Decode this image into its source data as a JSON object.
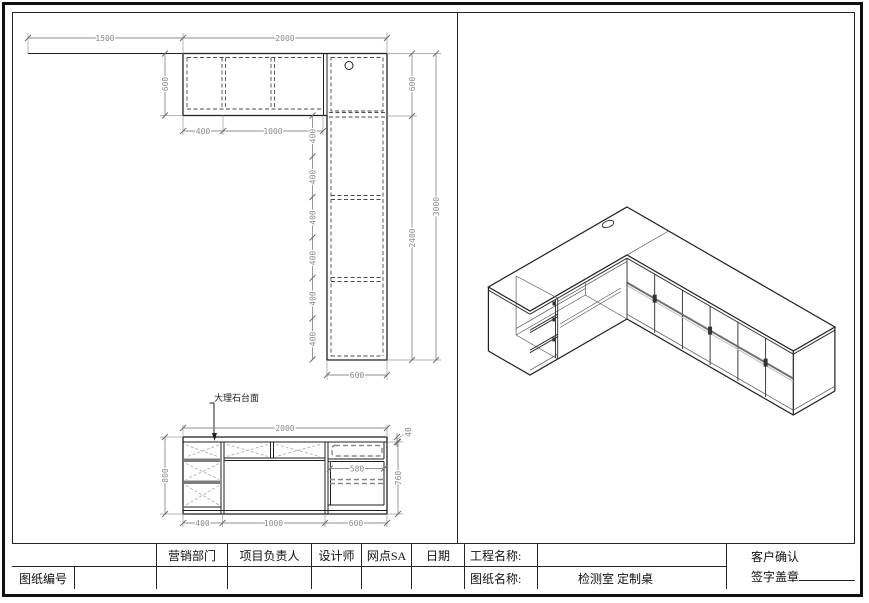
{
  "sheet": {
    "background": "#ffffff",
    "object_line_color": "#1f1f1f",
    "dimension_color": "#8a8a8a"
  },
  "plan": {
    "dim_wall_offset": "1500",
    "dim_top_width": "2000",
    "dim_depth_left": "600",
    "dim_comp_a": "400",
    "dim_comp_b": "1000",
    "dim_corner_depth": "600",
    "dim_arm_inner": "2400",
    "dim_total_length": "3000",
    "dim_arm_width": "600",
    "segments": [
      "400",
      "400",
      "400",
      "400",
      "400",
      "400"
    ]
  },
  "elevation": {
    "callout": "大理石台面",
    "dim_width": "2000",
    "dim_top_thickness": "40",
    "dim_height_total": "800",
    "dim_height_under_top": "760",
    "dim_inner_width": "580",
    "dim_bottom_a": "400",
    "dim_bottom_b": "1000",
    "dim_bottom_c": "600"
  },
  "title_block": {
    "marketing_dept": "营销部门",
    "project_manager": "项目负责人",
    "designer": "设计师",
    "outlet_sa": "网点SA",
    "date": "日期",
    "project_name_label": "工程名称:",
    "project_name_value": "",
    "customer_confirm": "客户确认",
    "signature_seal": "签字盖章",
    "drawing_number_label": "图纸编号",
    "drawing_number_value": "",
    "drawing_name_label": "图纸名称:",
    "drawing_name_value": "检测室 定制桌"
  }
}
